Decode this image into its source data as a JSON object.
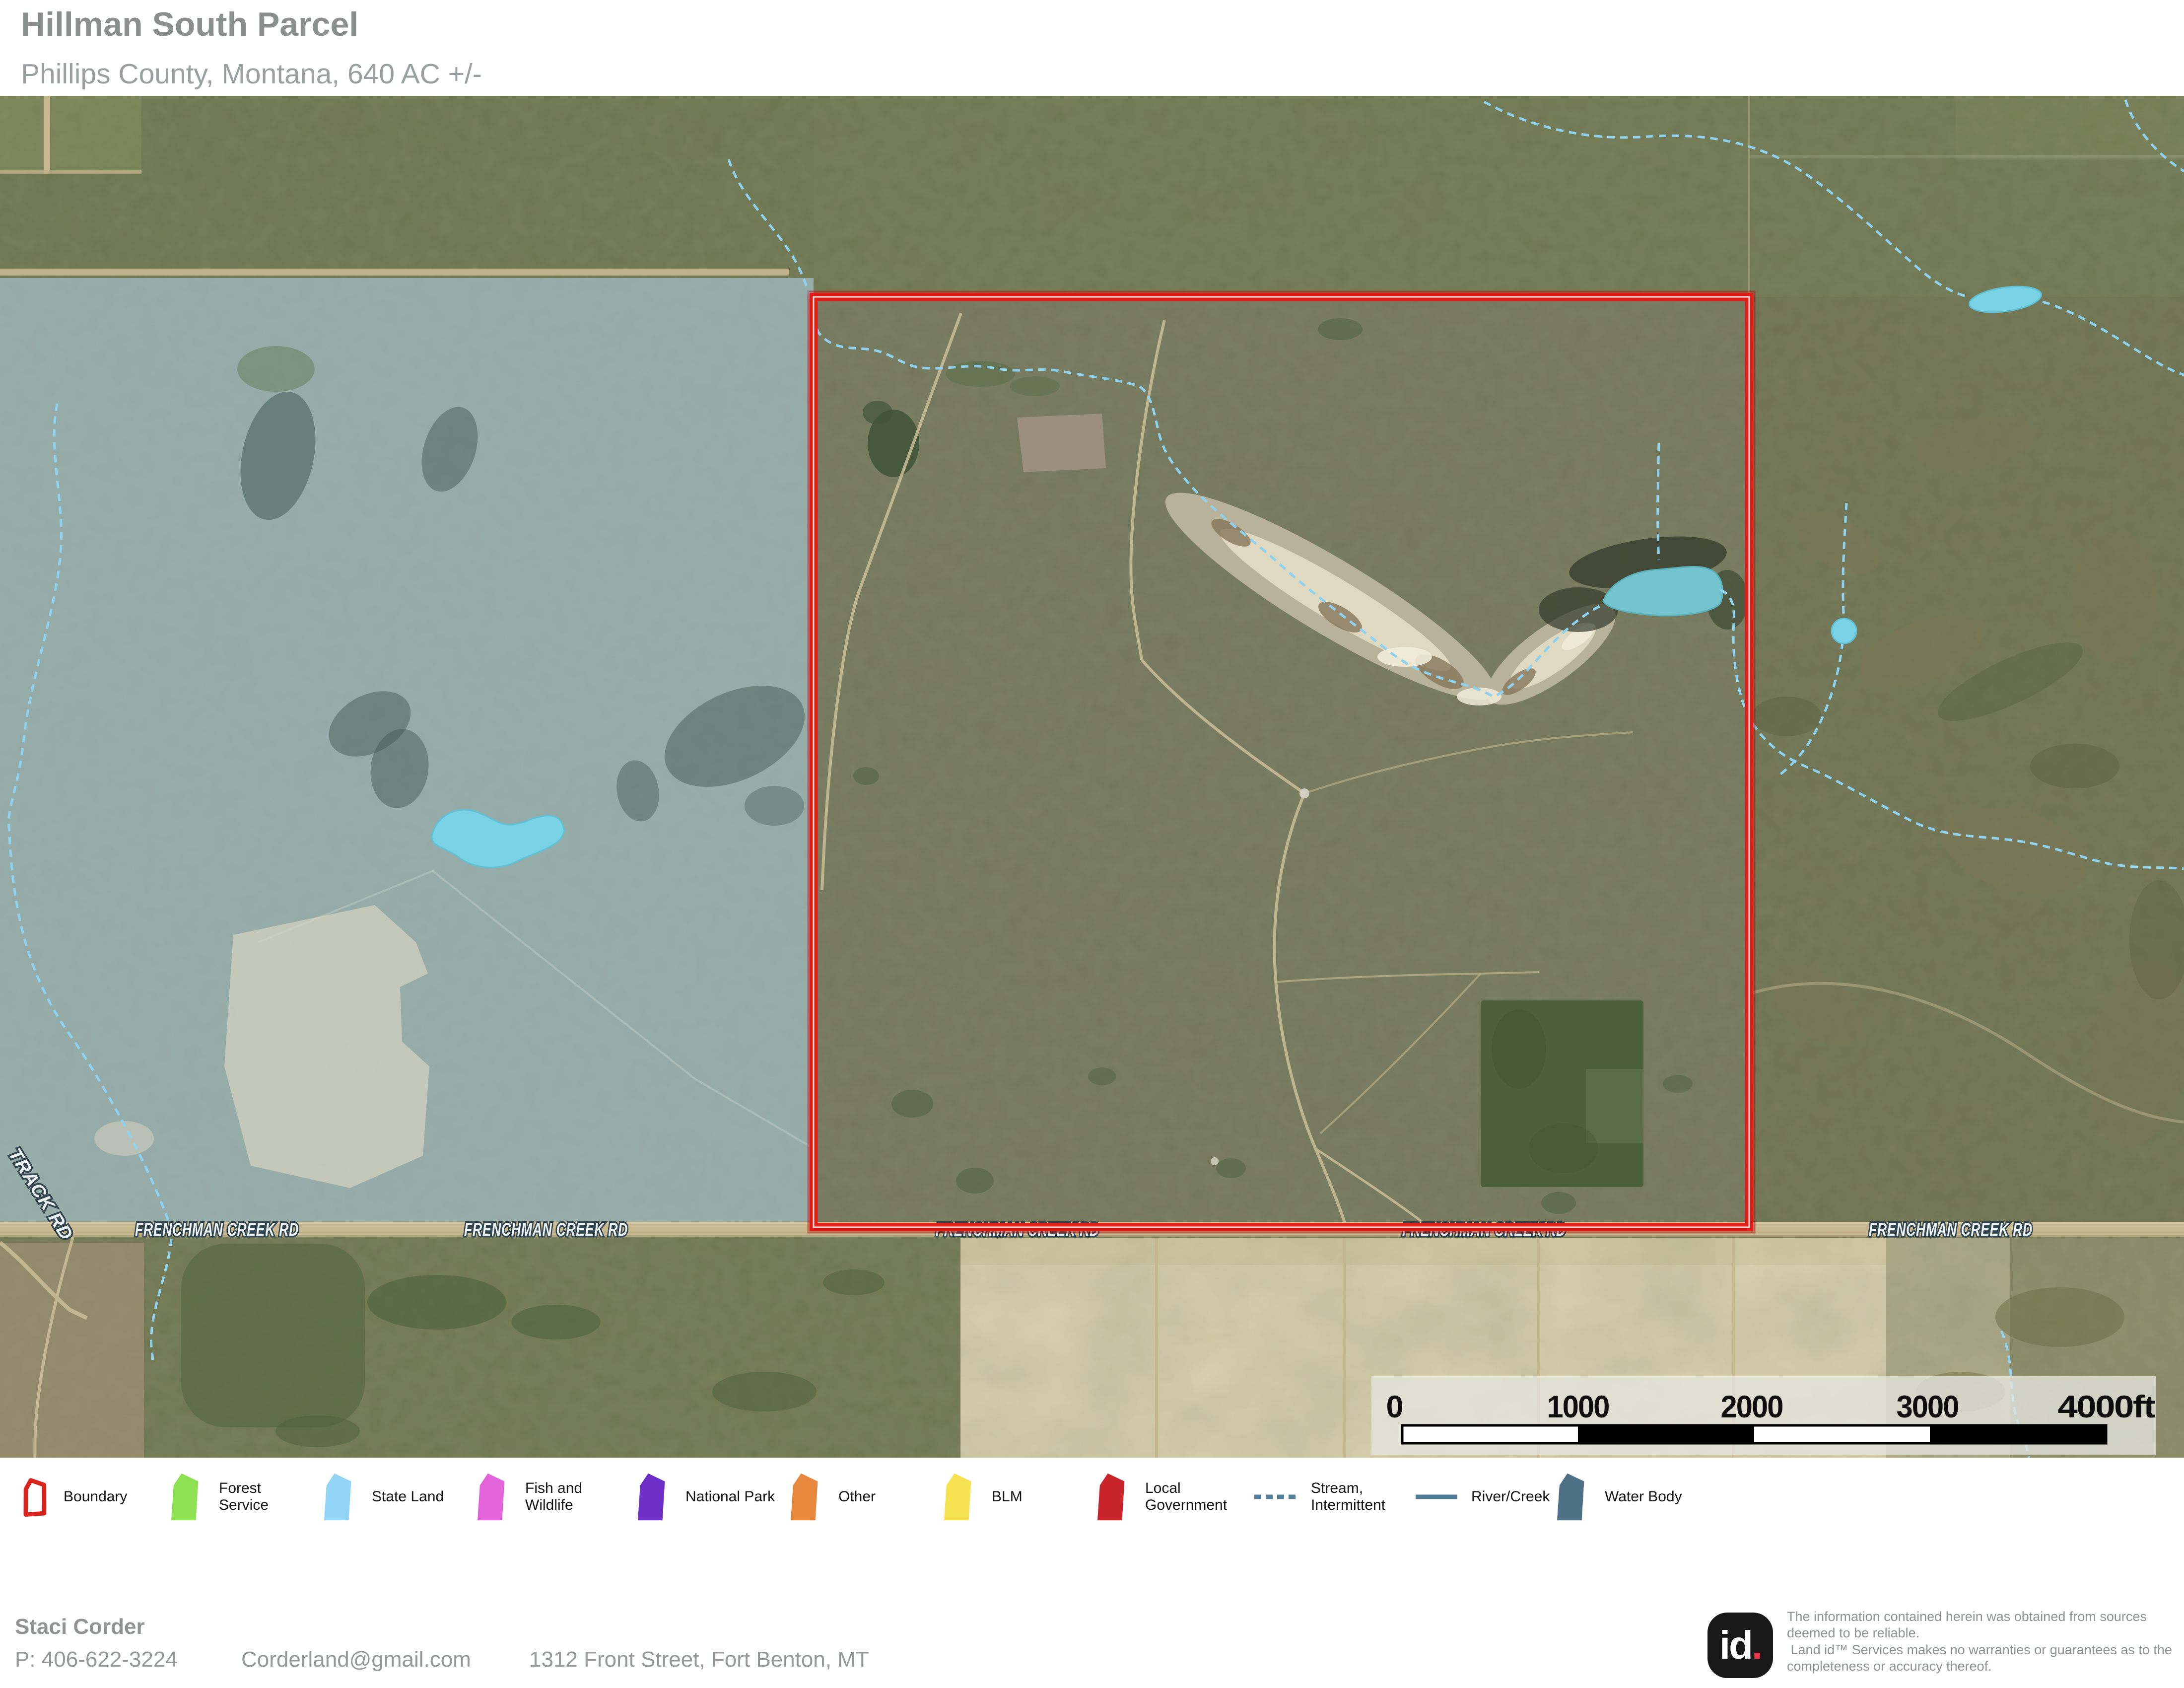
{
  "header": {
    "title": "Hillman South Parcel",
    "subtitle": "Phillips County, Montana, 640 AC +/-"
  },
  "map": {
    "road_label": "FRENCHMAN CREEK RD",
    "track_label": "TRACK RD",
    "scale_ticks": [
      "0",
      "1000",
      "2000",
      "3000",
      "4000ft"
    ]
  },
  "legend": {
    "items": [
      {
        "label": "Boundary",
        "type": "boundary-outline",
        "color": "#d8241c"
      },
      {
        "label": "Forest Service",
        "type": "polygon",
        "color": "#8ee153"
      },
      {
        "label": "State Land",
        "type": "polygon",
        "color": "#92d4f5"
      },
      {
        "label": "Fish and Wildlife",
        "type": "polygon",
        "color": "#e263da"
      },
      {
        "label": "National Park",
        "type": "polygon",
        "color": "#6d2fc6"
      },
      {
        "label": "Other",
        "type": "polygon",
        "color": "#e8883e"
      },
      {
        "label": "BLM",
        "type": "polygon",
        "color": "#f6e14e"
      },
      {
        "label": "Local Government",
        "type": "polygon",
        "color": "#c9242b"
      },
      {
        "label": "Stream, Intermittent",
        "type": "dashed-line",
        "color": "#54809b"
      },
      {
        "label": "River/Creek",
        "type": "solid-line",
        "color": "#4f7d98"
      },
      {
        "label": "Water Body",
        "type": "polygon",
        "color": "#4d7086"
      }
    ]
  },
  "footer": {
    "name": "Staci Corder",
    "phone": "P: 406-622-3224",
    "email": "Corderland@gmail.com",
    "address": "1312 Front Street, Fort Benton, MT"
  },
  "branding": {
    "logo_text": "id",
    "logo_dot": ".",
    "disclaimer_1": "The information contained herein was obtained from sources deemed to be reliable.",
    "disclaimer_2": " Land id™ Services makes no warranties or guarantees as to the completeness or accuracy thereof."
  },
  "colors": {
    "boundary_red": "#e11c16",
    "state_land_overlay": "#9fc7dd",
    "water_cyan": "#79d3e4",
    "lake_teal": "#74c4cf",
    "stream_cyan": "#8ed2f0",
    "road_tan": "#c6b78f"
  }
}
